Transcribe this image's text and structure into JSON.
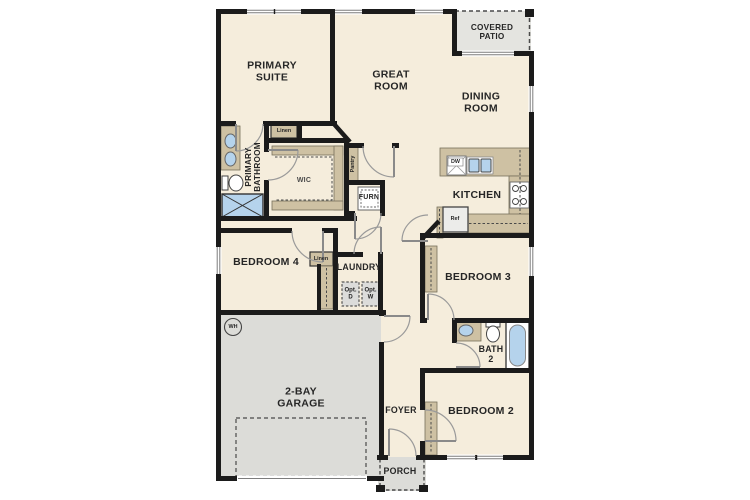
{
  "plan_title": "Single-story floor plan",
  "colors": {
    "wall": "#1b1b1b",
    "interior_fill": "#f5eddc",
    "outdoor_fill": "#dcdcd8",
    "patio_fill": "#e4e4e0",
    "cabinet_tan": "#cec1a3",
    "fixture_blue": "#b5d3ec",
    "door_arc_gray": "#9a9a9a",
    "label_text": "#262626"
  },
  "rooms": {
    "primary_suite": "PRIMARY\nSUITE",
    "great_room": "GREAT\nROOM",
    "covered_patio": "COVERED\nPATIO",
    "dining_room": "DINING\nROOM",
    "kitchen": "KITCHEN",
    "primary_bathroom": "PRIMARY\nBATHROOM",
    "wic": "WIC",
    "bedroom4": "BEDROOM 4",
    "laundry": "LAUNDRY",
    "bedroom3": "BEDROOM 3",
    "bath2": "BATH\n2",
    "bedroom2": "BEDROOM 2",
    "garage": "2-BAY\nGARAGE",
    "foyer": "FOYER",
    "porch": "PORCH"
  },
  "closets": {
    "linen_bath": "Linen",
    "linen_hall": "Linen",
    "pantry": "Pantry"
  },
  "fixtures": {
    "furnace": "FURN",
    "water_heater": "WH",
    "dishwasher": "DW",
    "refrigerator": "Ref",
    "optional_dryer": "Opt.\nD",
    "optional_washer": "Opt.\nW"
  }
}
